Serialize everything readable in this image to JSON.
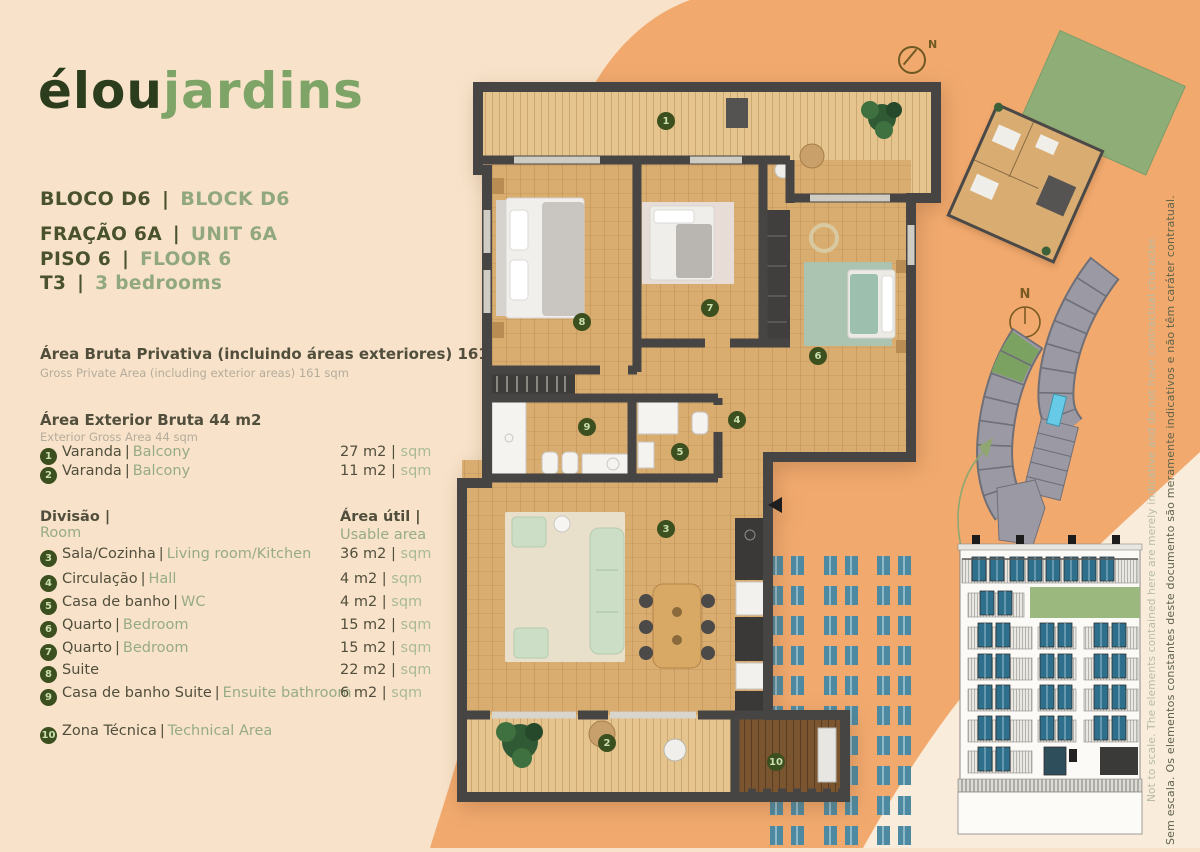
{
  "colors": {
    "background": "#f8e3ca",
    "orange_blob": "#f1a96e",
    "light_wedge": "#f9ecdb",
    "accent_dark": "#49522c",
    "accent_light": "#91a87e",
    "text_dark": "#514e3c",
    "text_muted": "#b5ab9b",
    "badge_green": "#3c4f1e",
    "wall_gray": "#474543",
    "wood": "#d9ac70",
    "deck": "#e6c48e",
    "teal_window": "#4d89a1",
    "roof_green": "#8fae77",
    "site_gray": "#9b9aa4",
    "pool_blue": "#67cbe7"
  },
  "logo": {
    "part1": "élou",
    "part2": "jardins"
  },
  "header": {
    "sep": "|",
    "block_pt": "BLOCO D6",
    "block_en": "BLOCK D6",
    "unit_pt": "FRAÇÃO 6A",
    "unit_en": "UNIT 6A",
    "floor_pt": "PISO 6",
    "floor_en": "FLOOR 6",
    "type_pt": "T3",
    "type_en": "3 bedrooms"
  },
  "areas": {
    "gross_private_pt": "Área Bruta Privativa (incluindo áreas exteriores) 161 m2",
    "gross_private_en": "Gross Private Area (including exterior areas) 161 sqm",
    "exterior_pt": "Área Exterior Bruta 44 m2",
    "exterior_en": "Exterior Gross Area 44 sqm"
  },
  "exterior_items": [
    {
      "num": "1",
      "pt": "Varanda",
      "sep": "|",
      "en": "Balcony",
      "val": "27 m2",
      "vsep": "|",
      "unit": "sqm"
    },
    {
      "num": "2",
      "pt": "Varanda",
      "sep": "|",
      "en": "Balcony",
      "val": "11 m2",
      "vsep": "|",
      "unit": "sqm"
    }
  ],
  "table": {
    "col1_pt": "Divisão |",
    "col1_en": "Room",
    "col2_pt": "Área útil |",
    "col2_en": "Usable area",
    "rows": [
      {
        "num": "3",
        "pt": "Sala/Cozinha",
        "sep": "|",
        "en": "Living room/Kitchen",
        "val": "36 m2",
        "vsep": "|",
        "unit": "sqm"
      },
      {
        "num": "4",
        "pt": "Circulação",
        "sep": "|",
        "en": "Hall",
        "val": "4 m2",
        "vsep": "|",
        "unit": "sqm"
      },
      {
        "num": "5",
        "pt": "Casa de banho",
        "sep": "|",
        "en": "WC",
        "val": "4 m2",
        "vsep": "|",
        "unit": "sqm"
      },
      {
        "num": "6",
        "pt": "Quarto",
        "sep": "|",
        "en": "Bedroom",
        "val": "15 m2",
        "vsep": "|",
        "unit": "sqm"
      },
      {
        "num": "7",
        "pt": "Quarto",
        "sep": "|",
        "en": "Bedroom",
        "val": "15 m2",
        "vsep": "|",
        "unit": "sqm"
      },
      {
        "num": "8",
        "pt": "Suite",
        "sep": "",
        "en": "",
        "val": "22 m2",
        "vsep": "|",
        "unit": "sqm"
      },
      {
        "num": "9",
        "pt": "Casa de banho Suite",
        "sep": "|",
        "en": "Ensuite bathroom",
        "val": "6 m2",
        "vsep": "|",
        "unit": "sqm"
      },
      {
        "num": "10",
        "pt": "Zona Técnica",
        "sep": "|",
        "en": "Technical Area",
        "val": "",
        "vsep": "",
        "unit": ""
      }
    ]
  },
  "plan": {
    "north_label": "N",
    "badges": [
      "1",
      "2",
      "3",
      "4",
      "5",
      "6",
      "7",
      "8",
      "9",
      "10"
    ]
  },
  "disclaimer": {
    "pt": "Sem escala. Os elementos constantes deste documento são meramente indicativos e não têm caráter contratual.",
    "en": "Not to scale. The elements contained here are merely indicative and do not have contractual character."
  }
}
